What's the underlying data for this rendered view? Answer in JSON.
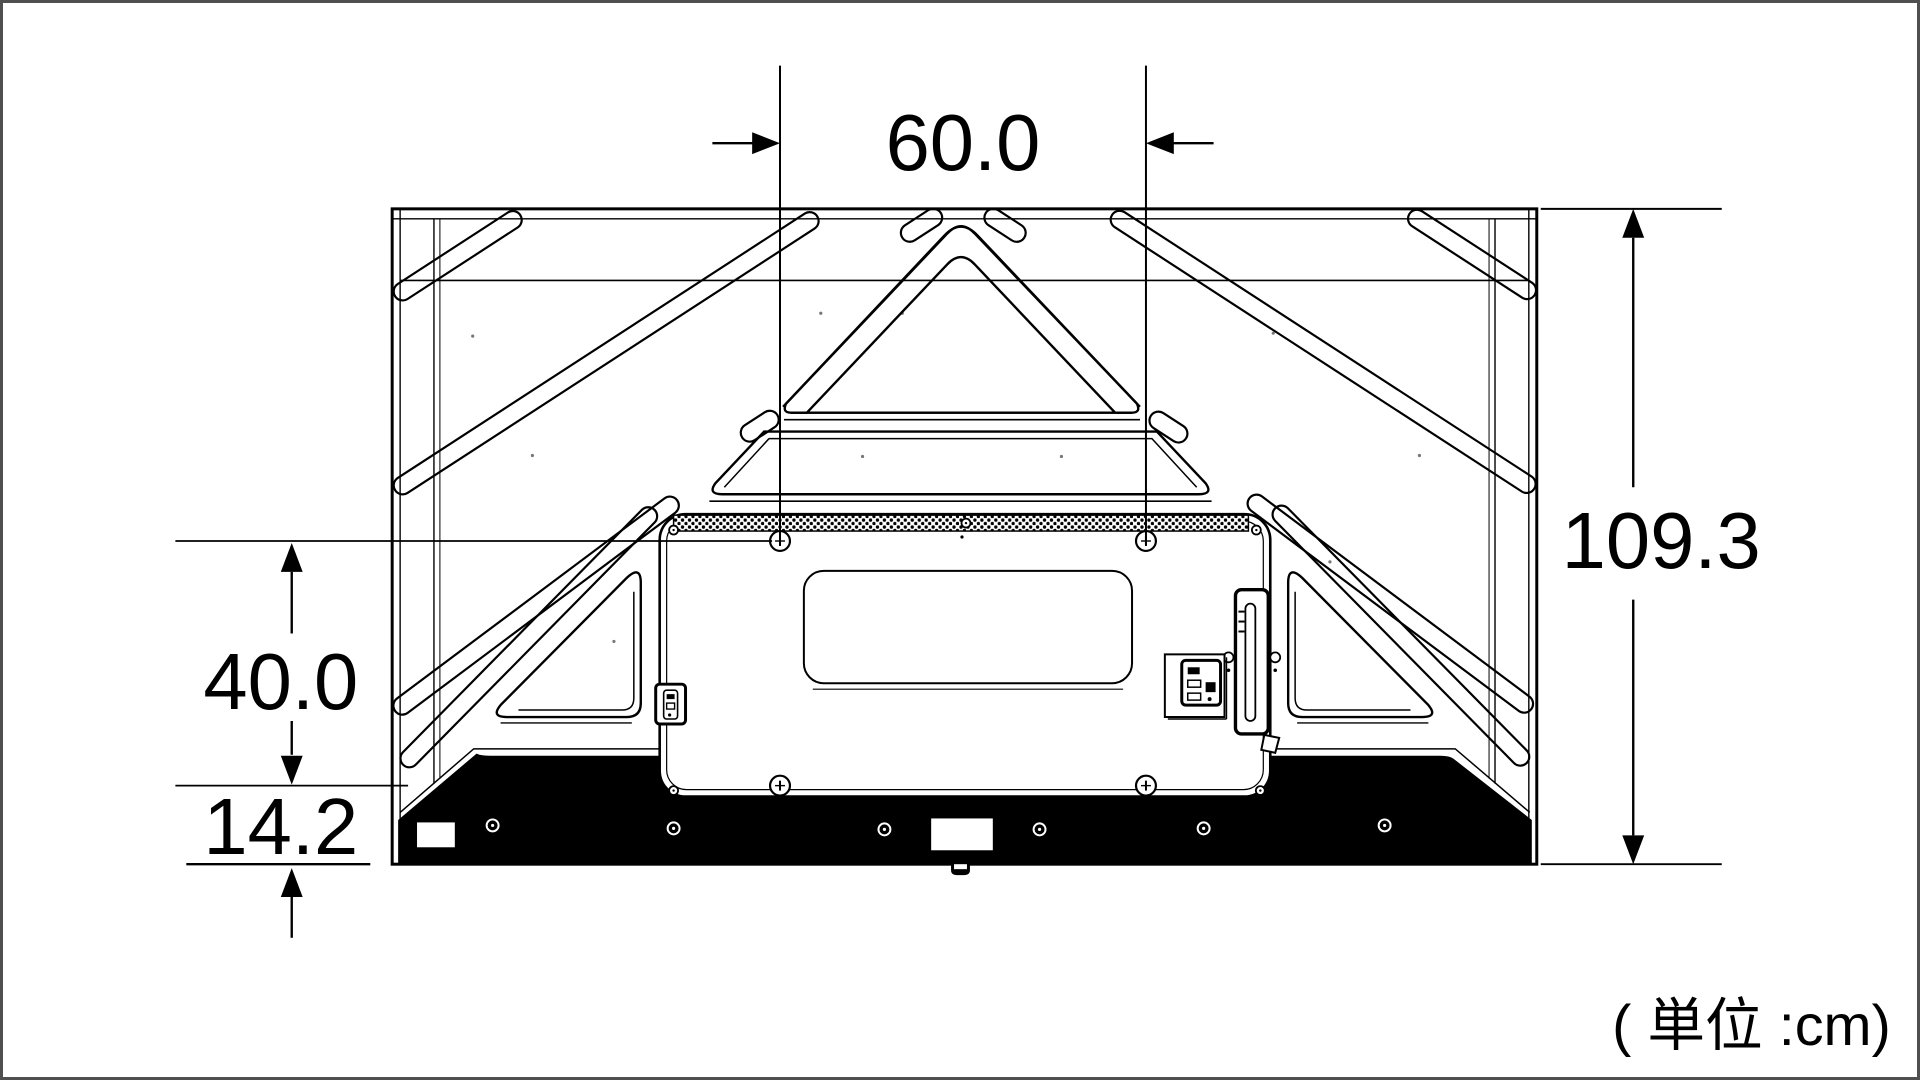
{
  "page": {
    "background_color": "#ffffff",
    "border_color": "#4f4f4f",
    "line_color": "#000000",
    "title": "TV rear view dimensional drawing"
  },
  "diagram": {
    "unit_note": "( 単位 :cm)",
    "dimensions": {
      "mount_width": {
        "label": "60.0"
      },
      "total_height": {
        "label": "109.3"
      },
      "mount_height": {
        "label": "40.0"
      },
      "bottom_offset": {
        "label": "14.2"
      }
    }
  }
}
